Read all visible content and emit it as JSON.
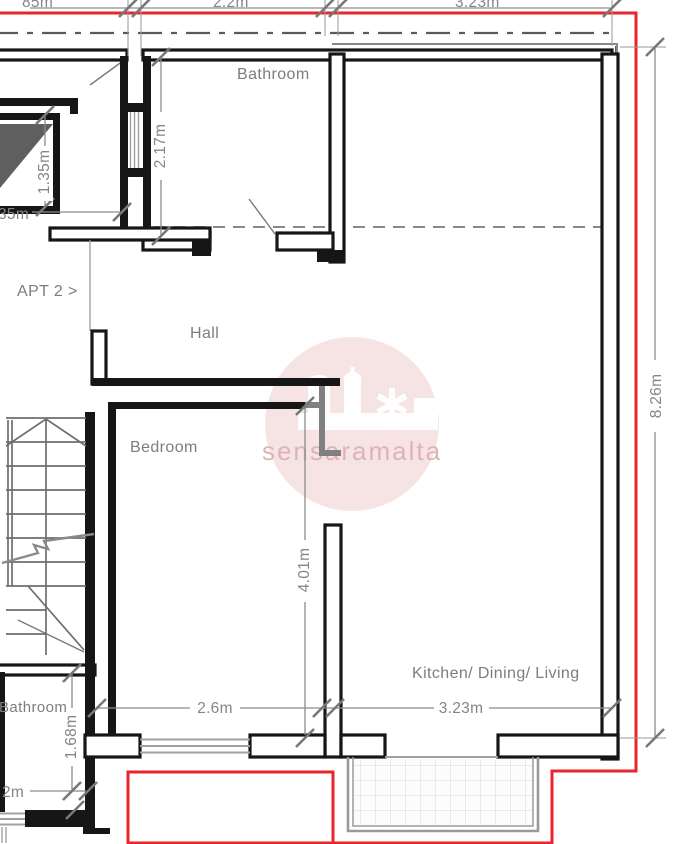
{
  "plan": {
    "apartment_label": "APT 2 >",
    "rooms": {
      "bathroom_top": "Bathroom",
      "hall": "Hall",
      "bedroom": "Bedroom",
      "kitchen": "Kitchen/ Dining/ Living",
      "bathroom_bottom": "Bathroom"
    },
    "dimensions": {
      "top_left_partial": "85m",
      "top_width_left": "2.2m",
      "top_width_right": "3.23m",
      "bathroom_depth": "2.17m",
      "shaft_height": "1.35m",
      "shaft_width_partial": "35m",
      "right_height": "8.26m",
      "bedroom_depth": "4.01m",
      "bedroom_width": "2.6m",
      "kitchen_width": "3.23m",
      "bathroom2_depth": "1.68m",
      "bathroom2_width_partial": "2m"
    },
    "watermark": {
      "text": "sensaramalta"
    },
    "colors": {
      "boundary_red": "#e8252a",
      "wall_black": "#161616",
      "dim_gray": "#858585",
      "shaft_fill": "#5f5f5f",
      "watermark_pink": "rgba(198,88,88,0.16)",
      "watermark_text": "#dfb3b3"
    }
  }
}
